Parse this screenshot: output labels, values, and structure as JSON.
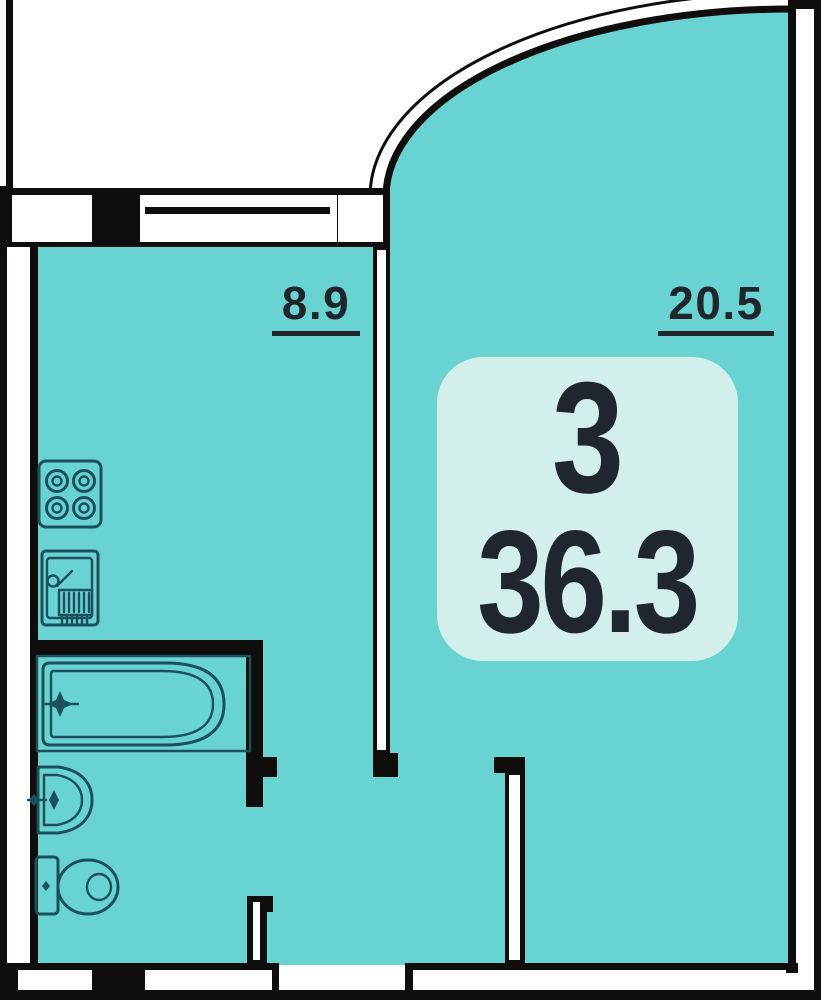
{
  "plan": {
    "rooms": [
      {
        "id": "kitchen",
        "area_label": "8.9"
      },
      {
        "id": "living-room",
        "area_label": "20.5"
      }
    ],
    "badge": {
      "top_value": "3",
      "bottom_value": "36.3"
    },
    "icons": {
      "stove": "4-burner-stove",
      "sink": "kitchen-sink-with-drainer",
      "bathtub": "bathtub-with-faucet",
      "washbasin": "washbasin",
      "toilet": "toilet"
    },
    "colors": {
      "room-fill": "#68d3d0",
      "badge-fill": "#d3efec",
      "wall": "#0f0e0c",
      "fixture-line": "#1c505a",
      "text": "#20262e",
      "outside": "#ffffff"
    }
  }
}
